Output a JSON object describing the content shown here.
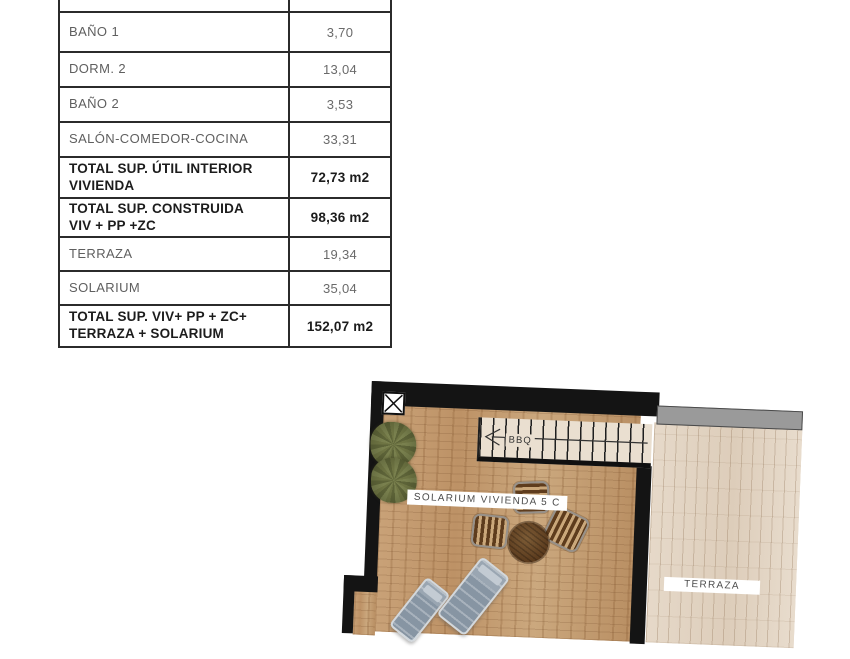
{
  "spec_table": {
    "rows": [
      {
        "label": "",
        "value": ""
      },
      {
        "label": "BAÑO 1",
        "value": "3,70"
      },
      {
        "label": "DORM. 2",
        "value": "13,04"
      },
      {
        "label": "BAÑO 2",
        "value": "3,53"
      },
      {
        "label": "SALÓN-COMEDOR-COCINA",
        "value": "33,31"
      },
      {
        "label": "TOTAL SUP. ÚTIL INTERIOR\nVIVIENDA",
        "value": "72,73 m2"
      },
      {
        "label": "TOTAL SUP. CONSTRUIDA\nVIV + PP +ZC",
        "value": "98,36 m2"
      },
      {
        "label": "TERRAZA",
        "value": "19,34"
      },
      {
        "label": "SOLARIUM",
        "value": "35,04"
      },
      {
        "label": "TOTAL SUP. VIV+ PP + ZC+\nTERRAZA + SOLARIUM",
        "value": "152,07 m2"
      }
    ]
  },
  "floorplan": {
    "solarium_label": "SOLARIUM VIVIENDA 5 C",
    "terraza_label": "TERRAZA",
    "stairs_label": "BBQ",
    "colors": {
      "wall": "#141414",
      "solarium_wood": "#c49d72",
      "terraza_wood": "#e2d4c3",
      "boundary_strip": "#9a9a9a",
      "plant_green": "#6b7040",
      "furniture_wood": "#6b4a2a",
      "lounger_gray": "#8795a3"
    }
  }
}
